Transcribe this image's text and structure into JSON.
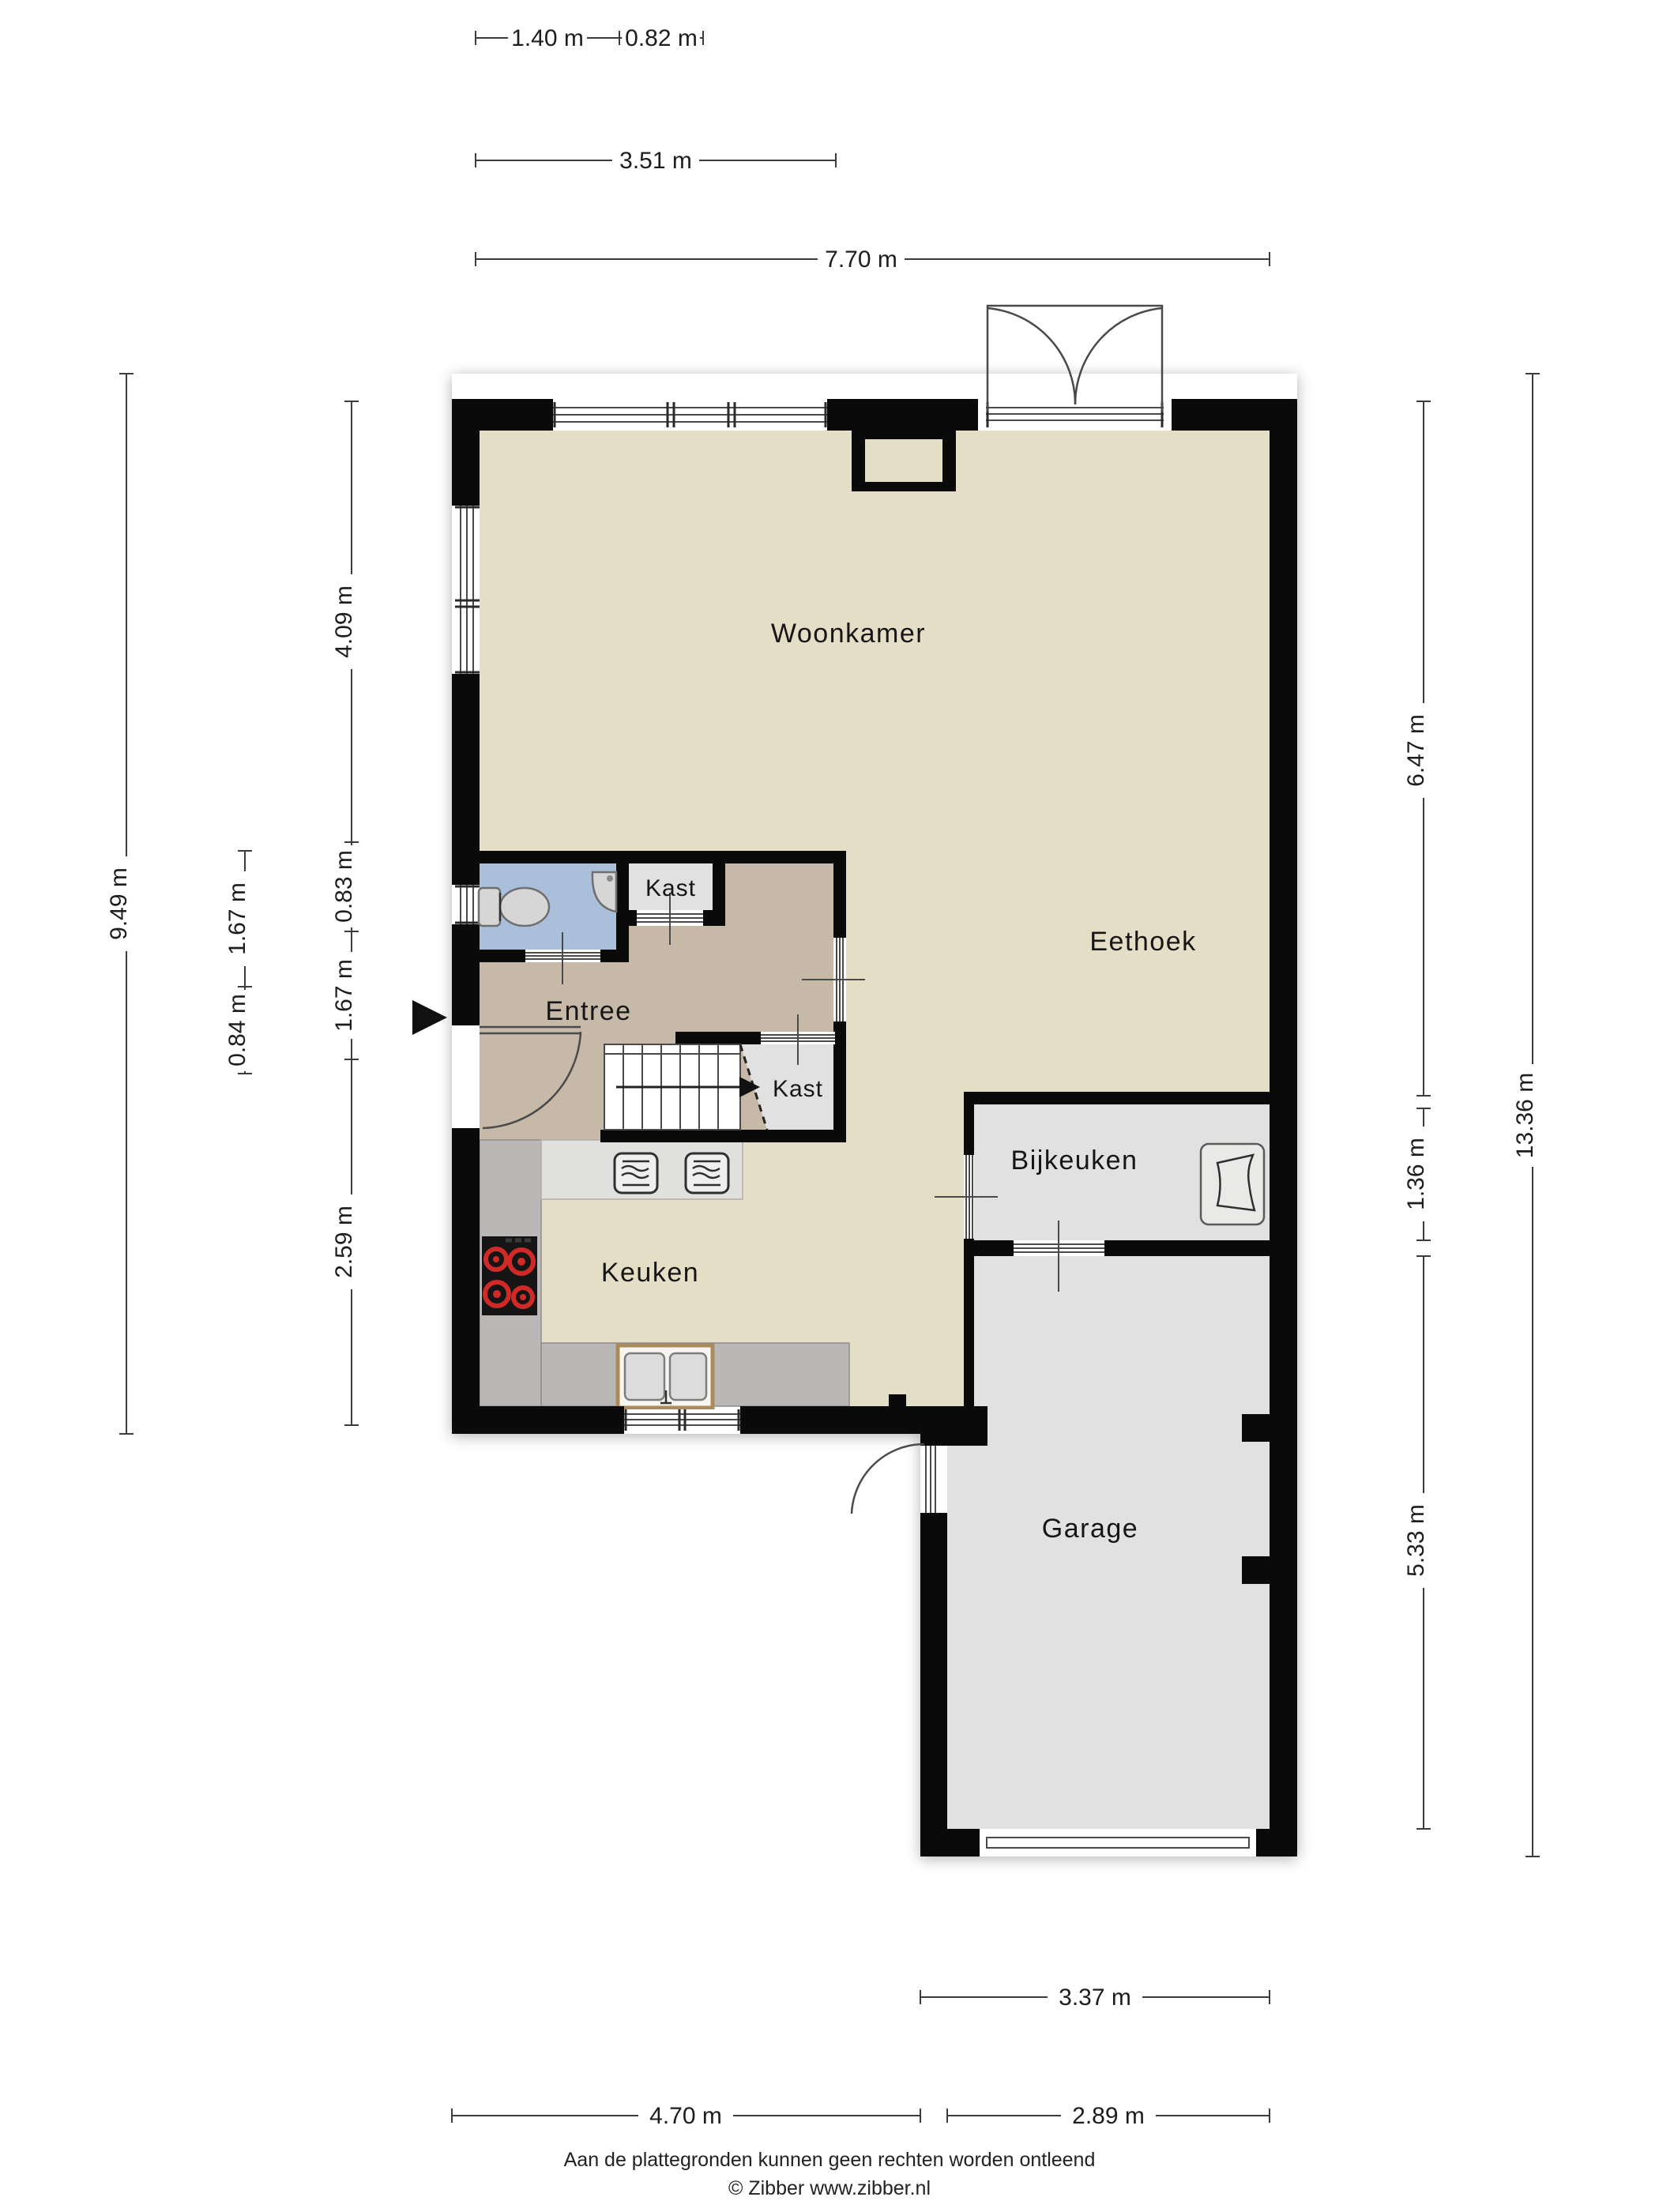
{
  "document": {
    "type": "floor-plan",
    "footer_line1": "Aan de plattegronden kunnen geen rechten worden ontleend",
    "footer_line2": "© Zibber www.zibber.nl"
  },
  "rooms": [
    {
      "name": "Woonkamer"
    },
    {
      "name": "Eethoek"
    },
    {
      "name": "Entree"
    },
    {
      "name": "Keuken"
    },
    {
      "name": "Bijkeuken"
    },
    {
      "name": "Garage"
    },
    {
      "name": "Kast"
    },
    {
      "name": "Kast"
    }
  ],
  "dims": {
    "top": [
      {
        "label": "1.40 m"
      },
      {
        "label": "0.82 m"
      },
      {
        "label": "3.51 m"
      },
      {
        "label": "7.70 m"
      }
    ],
    "left": [
      {
        "label": "9.49 m"
      },
      {
        "label": "1.67 m"
      },
      {
        "label": "0.84 m"
      },
      {
        "label": "4.09 m"
      },
      {
        "label": "0.83 m"
      },
      {
        "label": "1.67 m"
      },
      {
        "label": "2.59 m"
      }
    ],
    "right": [
      {
        "label": "6.47 m"
      },
      {
        "label": "1.36 m"
      },
      {
        "label": "5.33 m"
      },
      {
        "label": "13.36 m"
      }
    ],
    "bottom": [
      {
        "label": "3.37 m"
      },
      {
        "label": "4.70 m"
      },
      {
        "label": "2.89 m"
      }
    ]
  },
  "icons": [
    {
      "name": "toilet-icon"
    },
    {
      "name": "corner-sink-icon"
    },
    {
      "name": "oven-icon"
    },
    {
      "name": "cooktop-icon"
    },
    {
      "name": "kitchen-sink-icon"
    },
    {
      "name": "utility-sink-icon"
    },
    {
      "name": "stairs-icon"
    },
    {
      "name": "entrance-arrow-icon"
    },
    {
      "name": "fireplace-icon"
    }
  ],
  "colors": {
    "wall": "#0a0a0a",
    "floor_living": "#e5dec6",
    "floor_hall": "#c7b9a7",
    "floor_toilet": "#aac0da",
    "floor_utility": "#e1e1e1",
    "counter": "#b9b8b6",
    "burner_red": "#cf2a27",
    "sink_border": "#ab8a5c",
    "dimension_line": "#3c3c3c"
  }
}
